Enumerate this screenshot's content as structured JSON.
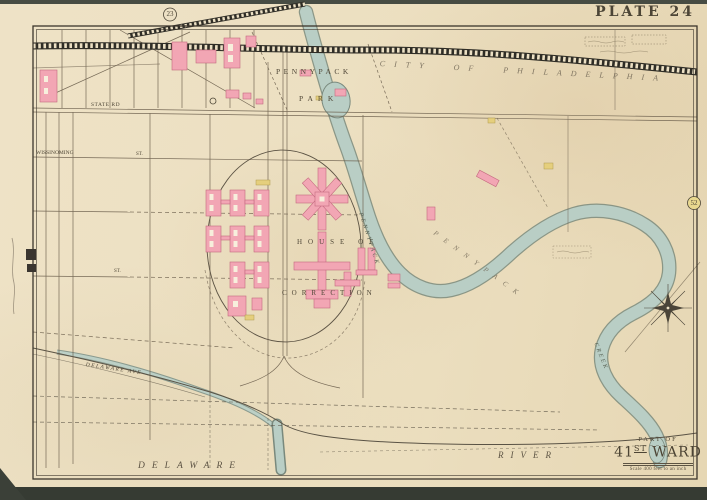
{
  "plate": {
    "title": "PLATE 24",
    "adjacent_plate_top": "23",
    "adjacent_plate_right": "52"
  },
  "cartouche": {
    "part_of": "PART OF",
    "ward_number": "41",
    "ward_ordinal": "ST",
    "ward_word": "WARD",
    "scale_note": "Scale 400 feet to an inch"
  },
  "labels": {
    "city": "CITY OF PHILADELPHIA",
    "park_line1": "PENNYPACK",
    "park_line2": "PARK",
    "creek_in_park": "PENNYPACK",
    "creek_bank": "PENNYPACK",
    "creek_lower": "CREEK",
    "institution_line1": "HOUSE OF",
    "institution_line2": "CORRECTION",
    "river_word1": "DELAWARE",
    "river_word2": "RIVER"
  },
  "streets": {
    "state_road": "STATE RD",
    "wissinoming": "WISSINOMING",
    "st_marks": [
      "ST.",
      "ST."
    ],
    "shore_road": "DELAWARE AVE"
  },
  "colors": {
    "paper": "#ece0c2",
    "ink": "#5f5343",
    "building_pink": "#f2a6b4",
    "building_yellow": "#e5cf7d",
    "water": "#b9cec5"
  }
}
